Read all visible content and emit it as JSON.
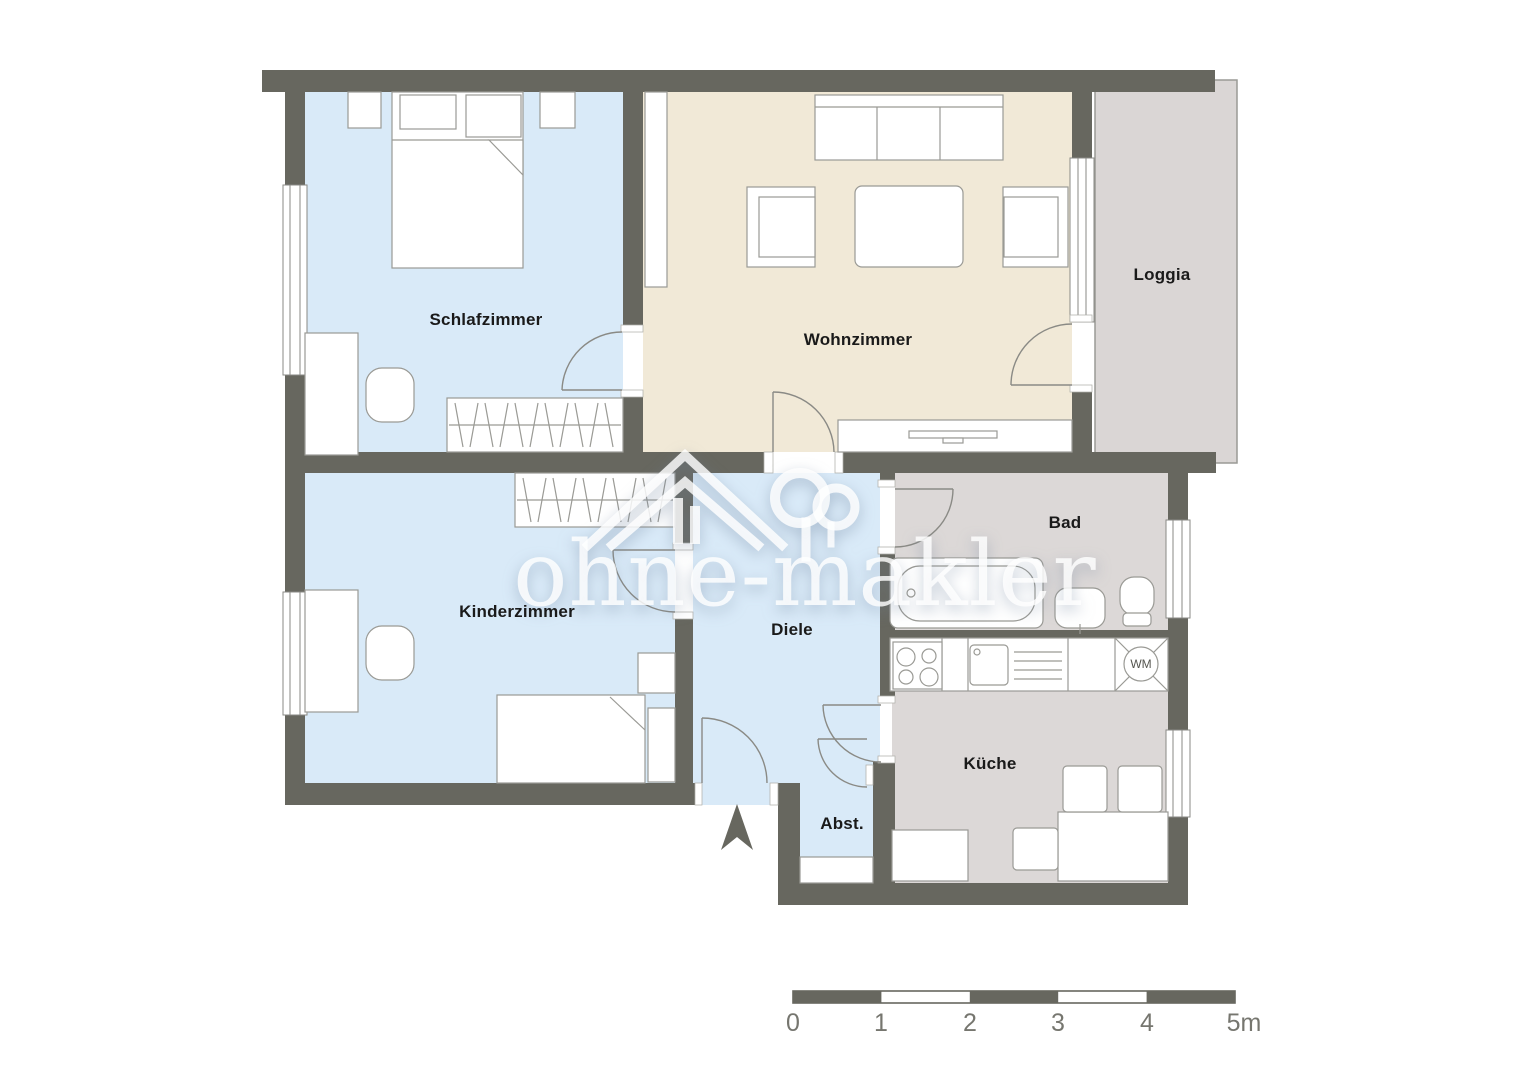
{
  "watermark": {
    "text": "ohne-makler"
  },
  "rooms": {
    "schlafzimmer": {
      "label": "Schlafzimmer"
    },
    "wohnzimmer": {
      "label": "Wohnzimmer"
    },
    "loggia": {
      "label": "Loggia"
    },
    "kinderzimmer": {
      "label": "Kinderzimmer"
    },
    "diele": {
      "label": "Diele"
    },
    "bad": {
      "label": "Bad"
    },
    "kueche": {
      "label": "Küche"
    },
    "abstellraum": {
      "label": "Abst."
    }
  },
  "appliances": {
    "washing_machine": "WM"
  },
  "scale_bar": {
    "labels": [
      "0",
      "1",
      "2",
      "3",
      "4",
      "5m"
    ]
  },
  "colors": {
    "wall": "#67675f",
    "floor_blue": "#d9eaf8",
    "floor_beige": "#f1e9d7",
    "floor_gray": "#dcd8d7",
    "loggia_floor": "#dad6d5",
    "outline": "#9a9a95",
    "door_line": "#8a8a85",
    "label_text": "#1a1a1a",
    "scale_text": "#76766f"
  }
}
